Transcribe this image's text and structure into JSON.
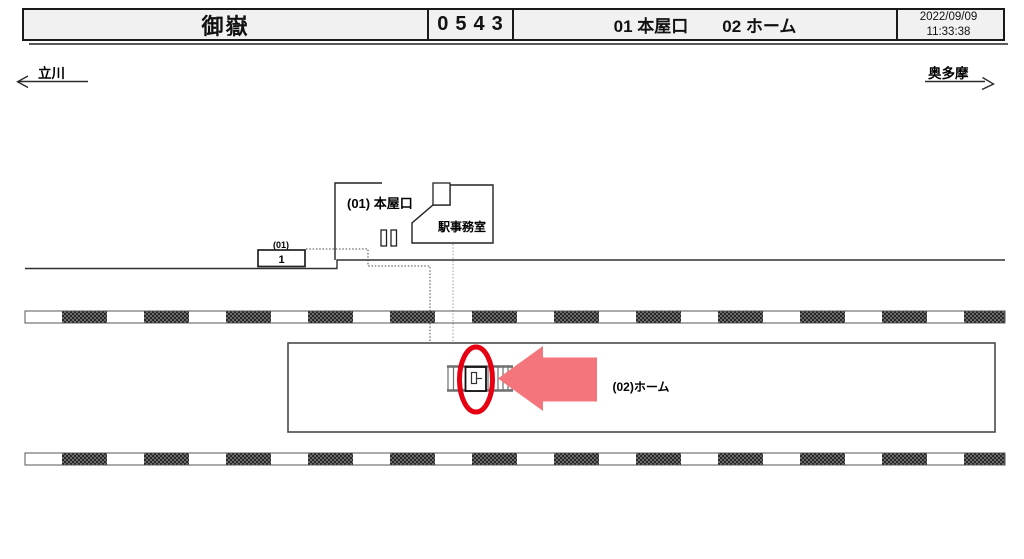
{
  "header": {
    "station_name": "御嶽",
    "station_code": "0543",
    "area1": "01 本屋口",
    "area2": "02 ホーム",
    "date": "2022/09/09",
    "time": "11:33:38"
  },
  "directions": {
    "left": "立川",
    "right": "奥多摩"
  },
  "map": {
    "entrance_label": "(01) 本屋口",
    "ticket_machine_label": "券売機",
    "office_label": "駅事務室",
    "device_group_label": "(01)",
    "device_number": "1",
    "platform_label": "(02)ホーム"
  },
  "colors": {
    "highlight_red": "#e60012",
    "arrow_red": "#f4767c",
    "header_bg": "#f1f1f1",
    "line": "#303030"
  }
}
